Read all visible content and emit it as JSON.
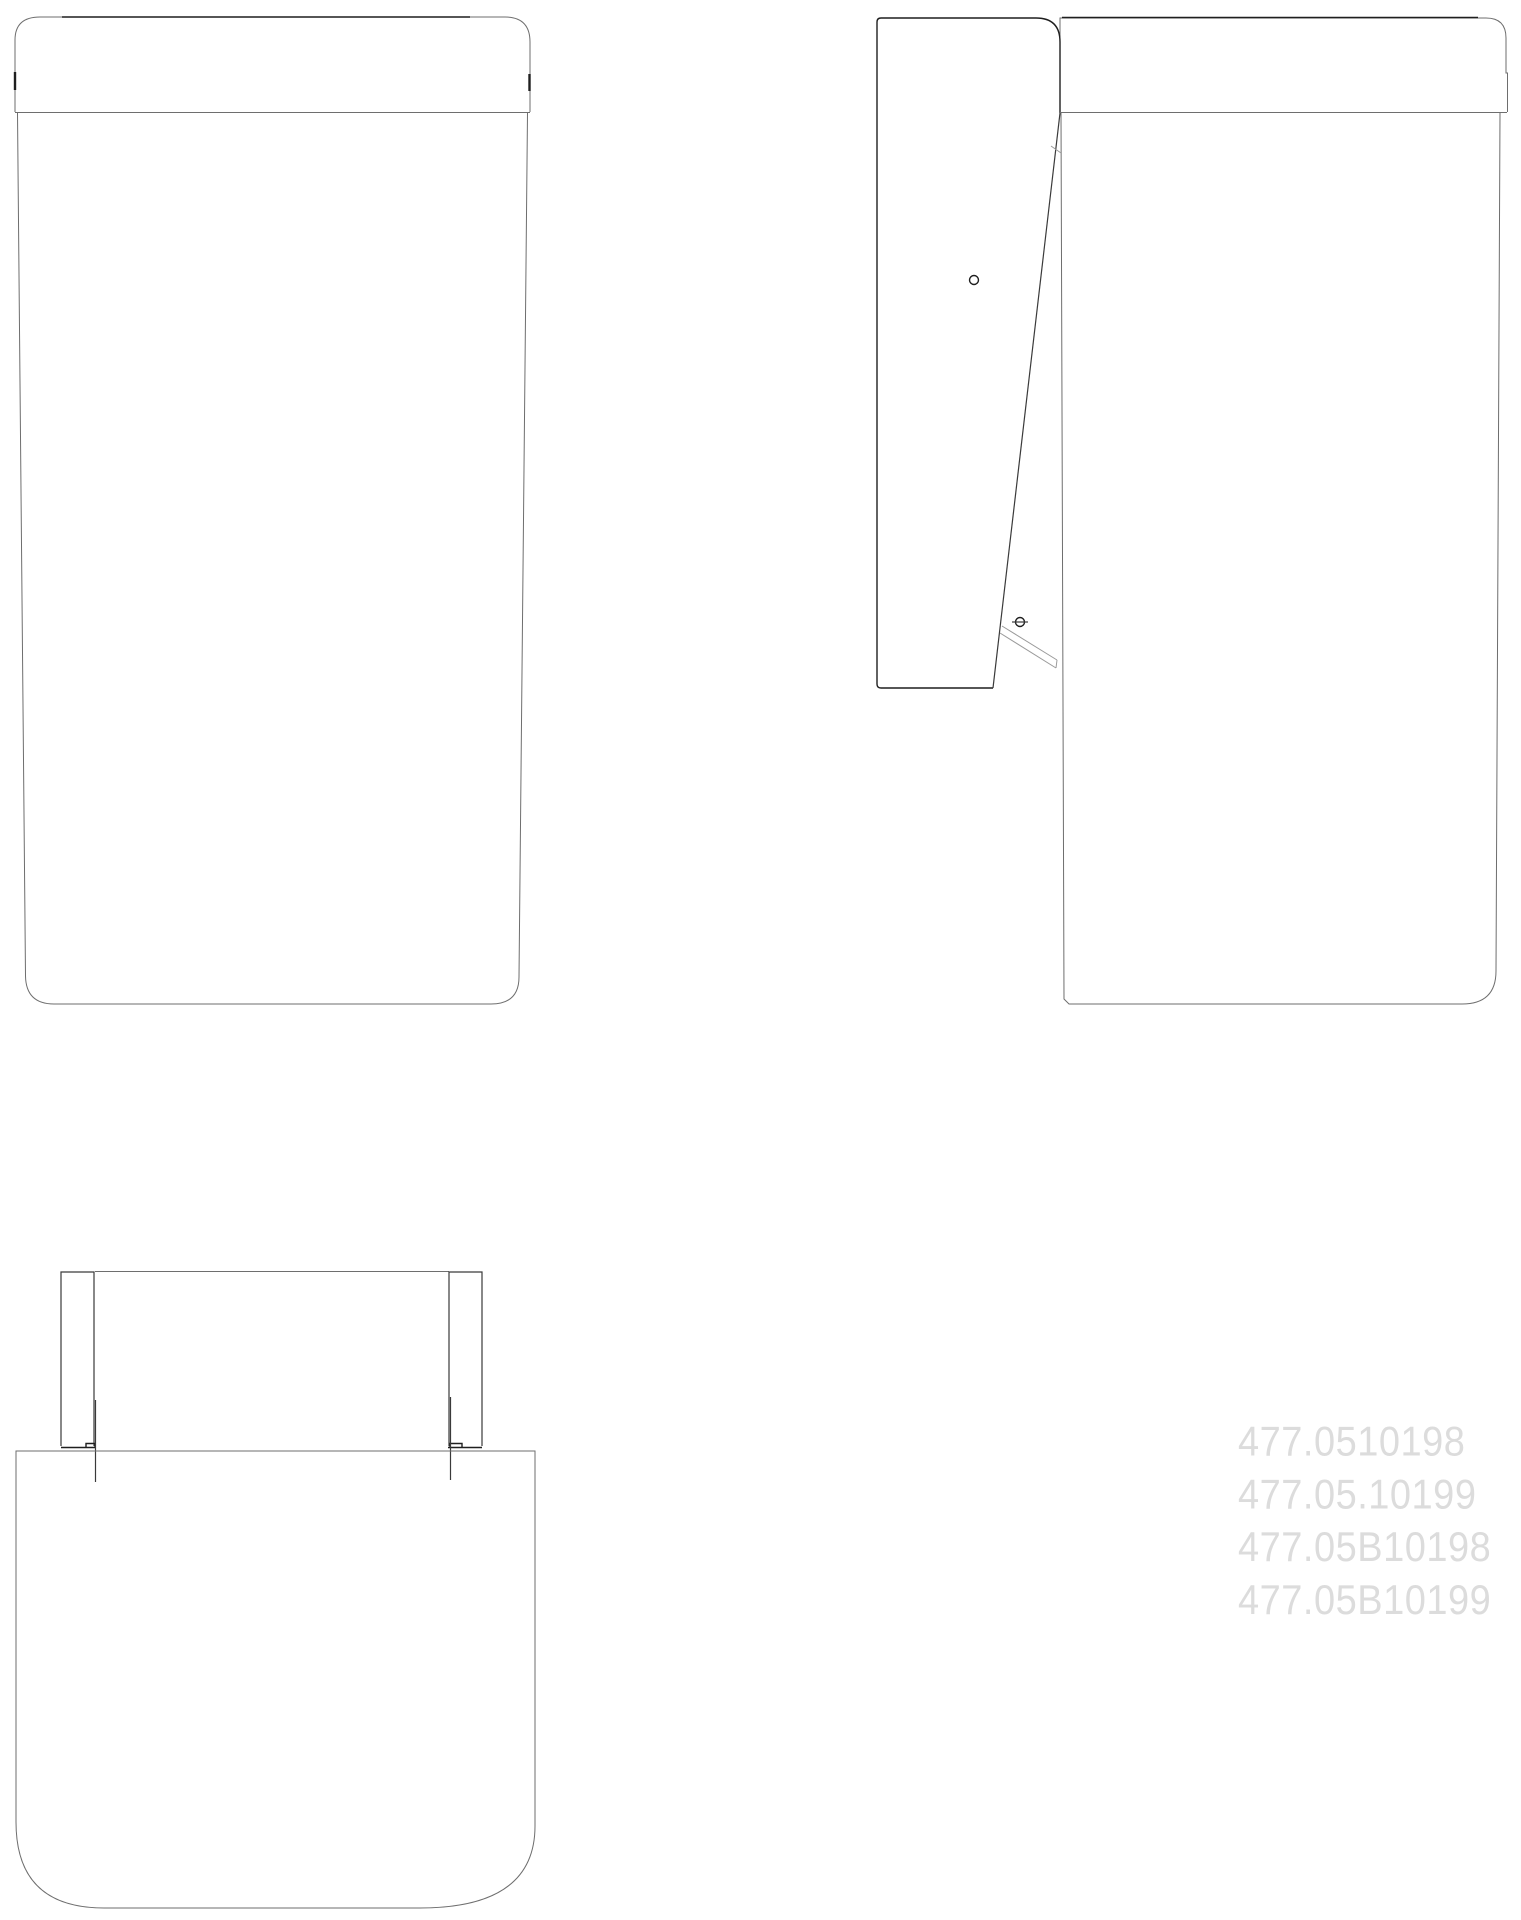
{
  "drawing": {
    "type": "technical-drawing",
    "description": "Three orthographic CAD views of a flap-door unit: front view, side view with open flap, and plan view",
    "part_numbers": [
      "477.0510198",
      "477.05.10199",
      "477.05B10198",
      "477.05B10199"
    ],
    "colors": {
      "background": "#ffffff",
      "line_black": "#1f1f1f",
      "line_dark": "#3a3a3a",
      "line_gray": "#6e6e6e",
      "line_light": "#9a9a9a",
      "watermark_text": "#dcdcdc"
    }
  }
}
